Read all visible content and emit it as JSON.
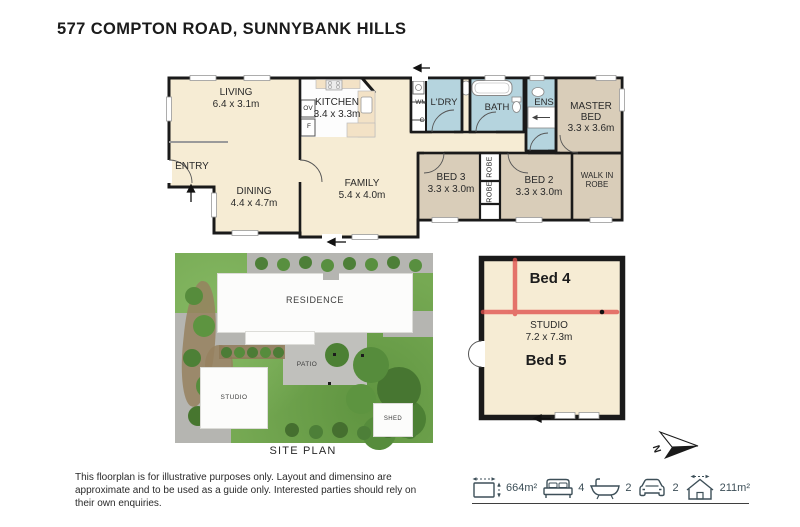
{
  "page": {
    "title": "577 COMPTON ROAD, SUNNYBANK HILLS"
  },
  "colors": {
    "room_cream": "#f6ecd4",
    "room_tan": "#d9cdb9",
    "wet_blue": "#b5d4de",
    "wall": "#1a1a1a",
    "marker_red": "#e0514d",
    "icon_slate": "#3d4f58"
  },
  "floorplan": {
    "living": {
      "name": "LIVING",
      "dims": "6.4 x 3.1m"
    },
    "dining": {
      "name": "DINING",
      "dims": "4.4 x 4.7m"
    },
    "entry": {
      "name": "ENTRY"
    },
    "kitchen": {
      "name": "KITCHEN",
      "dims": "3.4 x 3.3m"
    },
    "family": {
      "name": "FAMILY",
      "dims": "5.4 x 4.0m"
    },
    "oven": {
      "name": "OV"
    },
    "fridge": {
      "name": "F"
    },
    "wm": {
      "name": "WM"
    },
    "cupboard": {
      "name": "C"
    },
    "laundry": {
      "name": "L'DRY"
    },
    "bath": {
      "name": "BATH"
    },
    "ensuite": {
      "name": "ENS"
    },
    "master_bed": {
      "name": "MASTER BED",
      "dims": "3.3 x 3.6m"
    },
    "bed3": {
      "name": "BED 3",
      "dims": "3.3 x 3.0m"
    },
    "bed2": {
      "name": "BED 2",
      "dims": "3.3 x 3.0m"
    },
    "walk_in_robe": {
      "name": "WALK IN ROBE"
    },
    "robe_top": {
      "name": "ROBE"
    },
    "robe_bottom": {
      "name": "ROBE"
    }
  },
  "site_plan": {
    "residence": "RESIDENCE",
    "patio": "PATIO",
    "studio": "STUDIO",
    "shed": "SHED",
    "caption": "SITE PLAN"
  },
  "studio_plan": {
    "bed4": "Bed 4",
    "name": "STUDIO",
    "dims": "7.2 x 7.3m",
    "bed5": "Bed 5"
  },
  "compass": {
    "north": "N"
  },
  "footer": {
    "disclaimer": "This floorplan is for illustrative purposes only. Layout and dimensino are approximate and to be used as a guide only. Interested parties should rely on their own enquiries.",
    "land_area": "664m²",
    "beds": "4",
    "baths": "2",
    "cars": "2",
    "house_area": "211m²"
  }
}
